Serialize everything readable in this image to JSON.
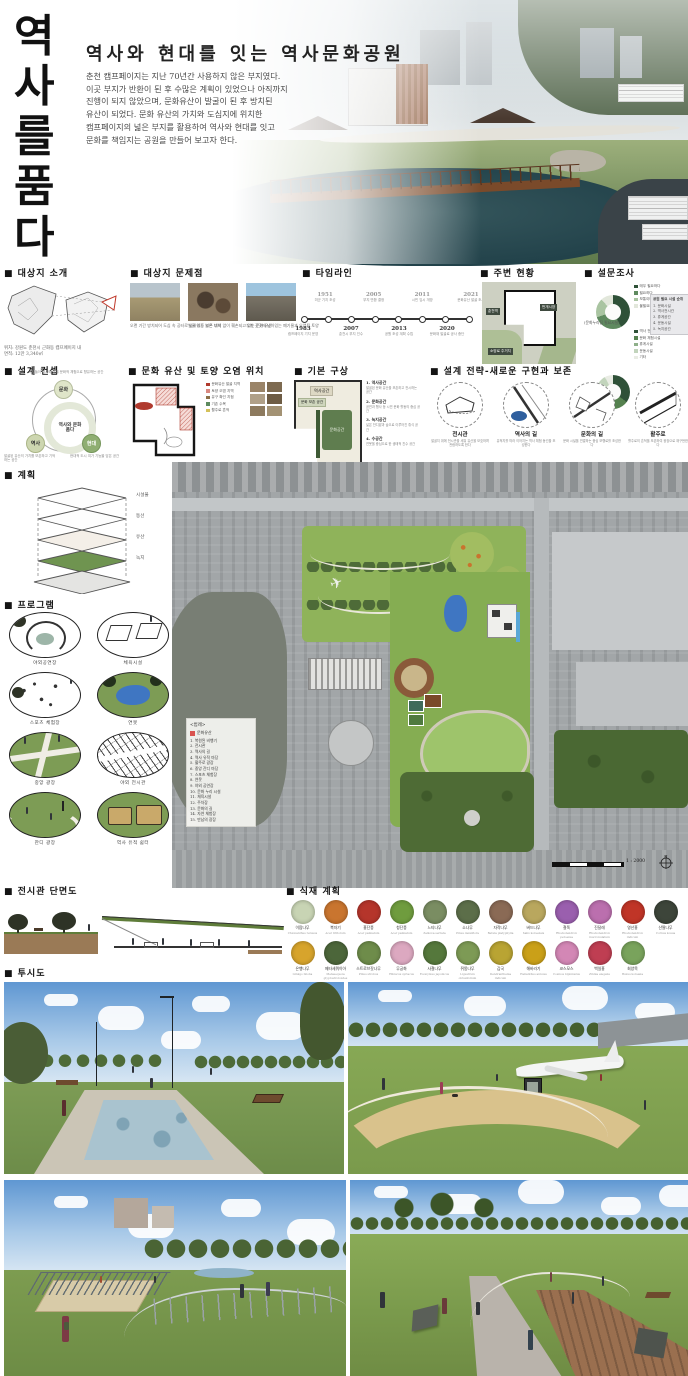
{
  "board": {
    "vertical_title": "역사를 품다",
    "title": "역사와 현대를 잇는 역사문화공원",
    "intro_lines": [
      "춘천 캠프페이지는 지난 70년간 사용하지 않은 부지였다.",
      "이곳 부지가 반환이 된 후 수많은 계획이 있었으나 아직까지",
      "진행이 되지 않았으며, 문화유산이 발굴이 된 후 방치된",
      "유산이 되었다. 문화 유산의 가치와 도심지에 위치한",
      "캠프페이지의 넓은 부지를 활용하여 역사와 현대를 잇고",
      "문화를 책임지는 공원을 만들어 보고자 한다."
    ]
  },
  "site_intro": {
    "header": "■ 대상지 소개",
    "location": "위치: 강원도 춘천시 근화동 캠프페이지 내",
    "area": "면적: 12만 3,340㎡"
  },
  "problems": {
    "header": "■ 대상지 문제점",
    "items": [
      {
        "caption": "오랜 기간 방치되어 도심 속 공터로 남아있는 넓은 부지"
      },
      {
        "caption": "발굴 이후 보존 대책 없이 훼손되고 있는 문화 유산"
      },
      {
        "caption": "부지 곳곳에 남아있는 폐기물과 오염된 토양"
      }
    ]
  },
  "timeline": {
    "header": "■ 타임라인",
    "events_top": [
      {
        "year": "1951",
        "desc": "미군 기지 조성"
      },
      {
        "year": "2005",
        "desc": "부지 반환 결정"
      },
      {
        "year": "2011",
        "desc": "시민 임시 개방"
      },
      {
        "year": "2021",
        "desc": "문화유산 발굴 조사"
      }
    ],
    "events_bottom": [
      {
        "year": "1983",
        "desc": "캠프페이지 기지 운영"
      },
      {
        "year": "2007",
        "desc": "춘천시 부지 인수"
      },
      {
        "year": "2013",
        "desc": "공원 조성 계획 수립"
      },
      {
        "year": "2020",
        "desc": "문화재 발굴로 공사 중단"
      }
    ]
  },
  "surroundings": {
    "header": "■ 주변 현황",
    "labels": [
      "춘천역",
      "번개시장",
      "소양로 주거지"
    ]
  },
  "survey": {
    "header": "■ 설문조사",
    "donut1_caption": "(공원 조성 필요도)",
    "donut2_caption": "(문화누리집 필요시설)",
    "donut1_legend": [
      {
        "label": "매우 필요하다",
        "color": "#2f5138"
      },
      {
        "label": "필요하다",
        "color": "#5f8a5f"
      },
      {
        "label": "보통이다",
        "color": "#a9c4a1"
      },
      {
        "label": "불필요하다",
        "color": "#e2e7db"
      }
    ],
    "donut2_legend": [
      {
        "label": "역사 전시시설",
        "color": "#2f5138"
      },
      {
        "label": "문화 체험시설",
        "color": "#55814f"
      },
      {
        "label": "휴게시설",
        "color": "#8fb08a"
      },
      {
        "label": "운동시설",
        "color": "#c2d4bc"
      },
      {
        "label": "기타",
        "color": "#e9ece4"
      }
    ],
    "rank_title": "공원 필요 시설 순위",
    "rank_items": [
      "1. 문화시설",
      "2. 역사전시관",
      "3. 휴게공간",
      "4. 운동시설",
      "5. 녹지공간"
    ]
  },
  "chart_data": [
    {
      "type": "pie",
      "title": "공원 조성 필요도",
      "labels": [
        "매우 필요하다",
        "필요하다",
        "보통이다",
        "불필요하다"
      ],
      "values": [
        42,
        28,
        18,
        12
      ],
      "colors": [
        "#2f5138",
        "#5f8a5f",
        "#a9c4a1",
        "#e2e7db"
      ]
    },
    {
      "type": "pie",
      "title": "문화누리집 필요시설",
      "labels": [
        "역사 전시시설",
        "문화 체험시설",
        "휴게시설",
        "운동시설",
        "기타"
      ],
      "values": [
        35,
        25,
        18,
        14,
        8
      ],
      "colors": [
        "#2f5138",
        "#55814f",
        "#8fb08a",
        "#c2d4bc",
        "#e9ece4"
      ]
    }
  ],
  "concept": {
    "header": "■ 설계 컨셉",
    "center": "역사와 문화 품다",
    "nodes": [
      {
        "label": "문화",
        "note": "시민들이 역사와 삶을 문화적 체험으로 향유하는 공간"
      },
      {
        "label": "역사",
        "note": "발굴된 유산의 가치를 보존하고 기억하는 공간"
      },
      {
        "label": "현대",
        "note": "현대적 도시 여가 기능을 담은 공간"
      }
    ]
  },
  "heritage_map": {
    "header": "■ 문화 유산 및 토양 오염 위치",
    "legend": [
      {
        "color": "#b03a2e",
        "label": "문화유산 발굴 지역"
      },
      {
        "color": "#d98880",
        "label": "토양 오염 지역"
      },
      {
        "color": "#8b6f47",
        "label": "유구 확인 지점"
      },
      {
        "color": "#5d8a5f",
        "label": "기존 수목"
      },
      {
        "color": "#d4c15a",
        "label": "활주로 흔적"
      }
    ]
  },
  "basic_plan": {
    "header": "■ 기본 구상",
    "zone_top": "역사공간",
    "zone_chip": "문화 보존 공간",
    "zone_green": "문화공간",
    "notes": [
      {
        "title": "1. 역사공간",
        "desc": "발굴된 문화 유산을 보존하고 전시하는 공간"
      },
      {
        "title": "2. 문화공간",
        "desc": "공연과 행사 등 시민 문화 활동의 중심 공간"
      },
      {
        "title": "3. 녹지공간",
        "desc": "넓은 잔디밭과 숲으로 이루어진 휴식 공간"
      },
      {
        "title": "4. 수공간",
        "desc": "연못을 중심으로 한 생태적 친수 공간"
      }
    ]
  },
  "strategy": {
    "header": "■ 설계 전략-새로운 구현과 보존",
    "items": [
      {
        "label": "전시관",
        "desc": "발굴지 위에 전시관을 세워 유산을 보호하며 관람하도록 한다"
      },
      {
        "label": "역사의 길",
        "desc": "유적지를 따라 이어지는 역사 체험 동선을 조성한다"
      },
      {
        "label": "문화의 길",
        "desc": "문화 시설을 연결하는 중심 보행로를 조성한다"
      },
      {
        "label": "활주로",
        "desc": "활주로의 흔적을 보존하여 광장으로 재구현한다"
      }
    ]
  },
  "layers": {
    "header": "■ 계획",
    "items": [
      "시설물",
      "동선",
      "유산",
      "녹지"
    ]
  },
  "program": {
    "header": "■ 프로그램",
    "items": [
      {
        "label": "야외공연장"
      },
      {
        "label": "체육시설"
      },
      {
        "label": "스포츠 체험장"
      },
      {
        "label": "연못"
      },
      {
        "label": "중앙 광장"
      },
      {
        "label": "야외 전시관"
      },
      {
        "label": "잔디 광장"
      },
      {
        "label": "역사 유적 쉼터"
      }
    ]
  },
  "master_plan": {
    "legend_title": "<범례>",
    "legend_heritage": "문화유산",
    "legend_items": [
      "1. 복원된 비행기",
      "2. 전시관",
      "3. 역사의 길",
      "4. 역사 유적 마당",
      "5. 활주로 광장",
      "6. 중앙 잔디 마당",
      "7. 스포츠 체험장",
      "8. 연못",
      "9. 야외 공연장",
      "10. 문화 누리 시설",
      "11. 체육시설",
      "12. 주차장",
      "13. 문화의 길",
      "14. 자연 체험장",
      "15. 만남의 광장"
    ],
    "scale": "1 : 2000",
    "north": "N"
  },
  "section_view": {
    "header": "■ 전시관 단면도"
  },
  "planting": {
    "header": "■ 식재 계획",
    "row1": [
      {
        "name": "이팝나무",
        "latin": "Chionanthus retusus",
        "color": "#c8d4b4"
      },
      {
        "name": "복자기",
        "latin": "Acer triflorum",
        "color": "#c9752f"
      },
      {
        "name": "홍단풍",
        "latin": "Acer palmatum",
        "color": "#b5352b"
      },
      {
        "name": "청단풍",
        "latin": "Acer palmatum",
        "color": "#6f9c3e"
      },
      {
        "name": "느티나무",
        "latin": "Zelkova serrata",
        "color": "#7a8d62"
      },
      {
        "name": "소나무",
        "latin": "Pinus densiflora",
        "color": "#5c6e49"
      },
      {
        "name": "자작나무",
        "latin": "Betula platyphylla",
        "color": "#8a6a55"
      },
      {
        "name": "버드나무",
        "latin": "Salix koreensis",
        "color": "#b9a75e"
      },
      {
        "name": "철쭉",
        "latin": "Rhododendron yedoense",
        "color": "#9a5fae"
      },
      {
        "name": "진달래",
        "latin": "Rhododendron mucronulatum",
        "color": "#bb6fae"
      },
      {
        "name": "영산홍",
        "latin": "Rhododendron indicum",
        "color": "#c03527"
      },
      {
        "name": "산딸나무",
        "latin": "Cornus kousa",
        "color": "#3d453a"
      }
    ],
    "row2": [
      {
        "name": "은행나무",
        "latin": "Ginkgo biloba",
        "color": "#d7a42c"
      },
      {
        "name": "메타세쿼이아",
        "latin": "Metasequoia glyptostroboides",
        "color": "#4c663a"
      },
      {
        "name": "스트로브잣나무",
        "latin": "Pinus strobus",
        "color": "#6e8c4a"
      },
      {
        "name": "무궁화",
        "latin": "Hibiscus syriacus",
        "color": "#dca8c0"
      },
      {
        "name": "사철나무",
        "latin": "Euonymus japonicus",
        "color": "#55783c"
      },
      {
        "name": "쥐똥나무",
        "latin": "Ligustrum obtusifolium",
        "color": "#7d9a55"
      },
      {
        "name": "감국",
        "latin": "Dendranthema indicum",
        "color": "#b9a433"
      },
      {
        "name": "해바라기",
        "latin": "Helianthus annuus",
        "color": "#caa018"
      },
      {
        "name": "코스모스",
        "latin": "Cosmos bipinnatus",
        "color": "#d387b5"
      },
      {
        "name": "백일홍",
        "latin": "Zinnia elegans",
        "color": "#bf3e52"
      },
      {
        "name": "회양목",
        "latin": "Buxus koreana",
        "color": "#79a35c"
      }
    ]
  },
  "perspective": {
    "header": "■ 투시도"
  }
}
